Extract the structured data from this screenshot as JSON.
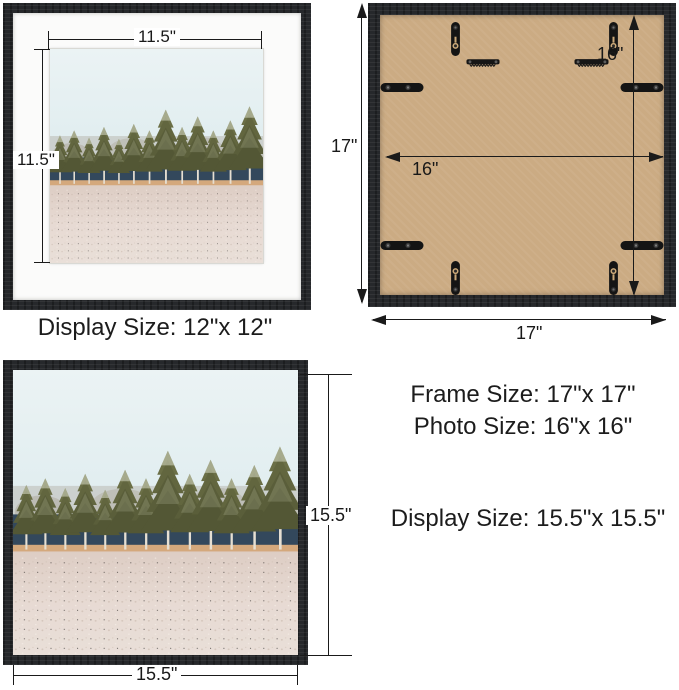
{
  "front": {
    "width_label": "11.5\"",
    "height_label": "11.5\"",
    "caption": "Display Size: 12\"x 12\""
  },
  "back": {
    "left_label": "17\"",
    "bottom_label": "17\"",
    "inner_v_label": "16\"",
    "inner_h_label": "16\""
  },
  "photo": {
    "height_label": "15.5\"",
    "width_label": "15.5\""
  },
  "specs": {
    "frame": "Frame Size: 17\"x 17\"",
    "photo": "Photo Size: 16\"x 16\"",
    "display": "Display Size: 15.5\"x 15.5\""
  },
  "palette": {
    "frame_wood": "#26282b",
    "mat": "#fbfbfa",
    "board_kraft": "#cbab83",
    "dimension_line": "#1a1a1a",
    "sky": "#e7f0f2",
    "dark_forest": "#33485c",
    "conifer": "#62663f",
    "soil_strip": "#d4a87c",
    "frost_ground": "#e4d6ce"
  }
}
